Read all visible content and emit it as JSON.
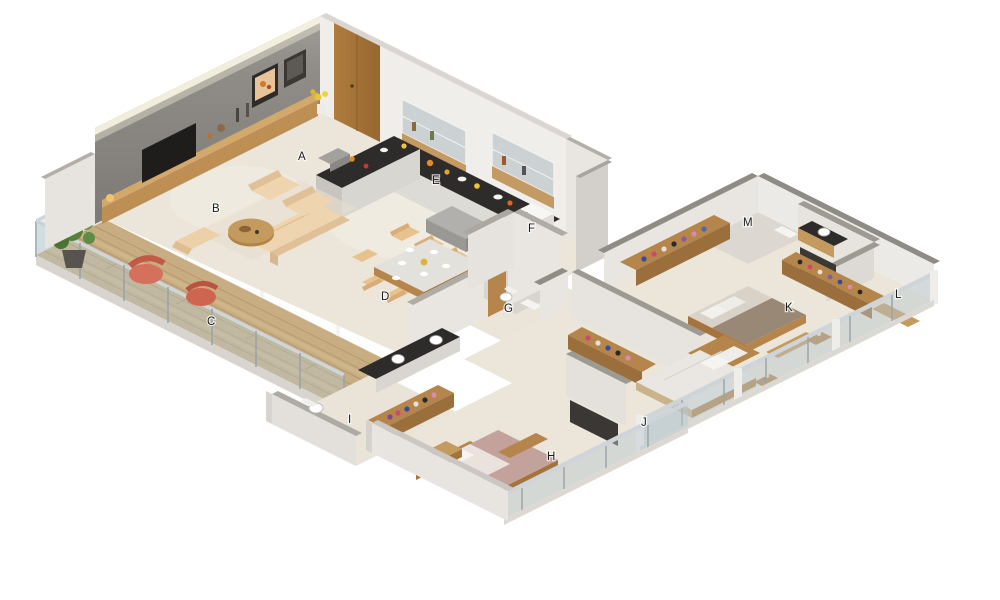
{
  "figure": {
    "type": "isometric-3d-floor-plan",
    "background": "#ffffff",
    "room_labels": [
      {
        "letter": "A"
      },
      {
        "letter": "B"
      },
      {
        "letter": "C"
      },
      {
        "letter": "D"
      },
      {
        "letter": "E"
      },
      {
        "letter": "F"
      },
      {
        "letter": "G"
      },
      {
        "letter": "H"
      },
      {
        "letter": "I"
      },
      {
        "letter": "J"
      },
      {
        "letter": "K"
      },
      {
        "letter": "L"
      },
      {
        "letter": "M"
      }
    ],
    "palette": {
      "floor_cream": "#ece6da",
      "floor_grey": "#d8d4ce",
      "deck_wood": "#c8ad82",
      "feature_wall_grey": "#8e8c88",
      "wall_face_white": "#eceae6",
      "wall_cap_dark": "#8f8b85",
      "wall_cap_light": "#b3aea8",
      "counter_dark": "#2e2b2b",
      "wood": "#b5854c",
      "wood_light": "#cb9a61",
      "sofa_beige": "#ecd2ab",
      "chair_beige": "#e8c28d",
      "accent_red": "#d4705c",
      "plant_green": "#55803c",
      "glass": "#b8c8ce",
      "bed_mauve": "#c3a29c",
      "bed_white": "#eae7e2",
      "bed_brown": "#9a8876",
      "appliance_white": "#f4f3f1"
    }
  }
}
